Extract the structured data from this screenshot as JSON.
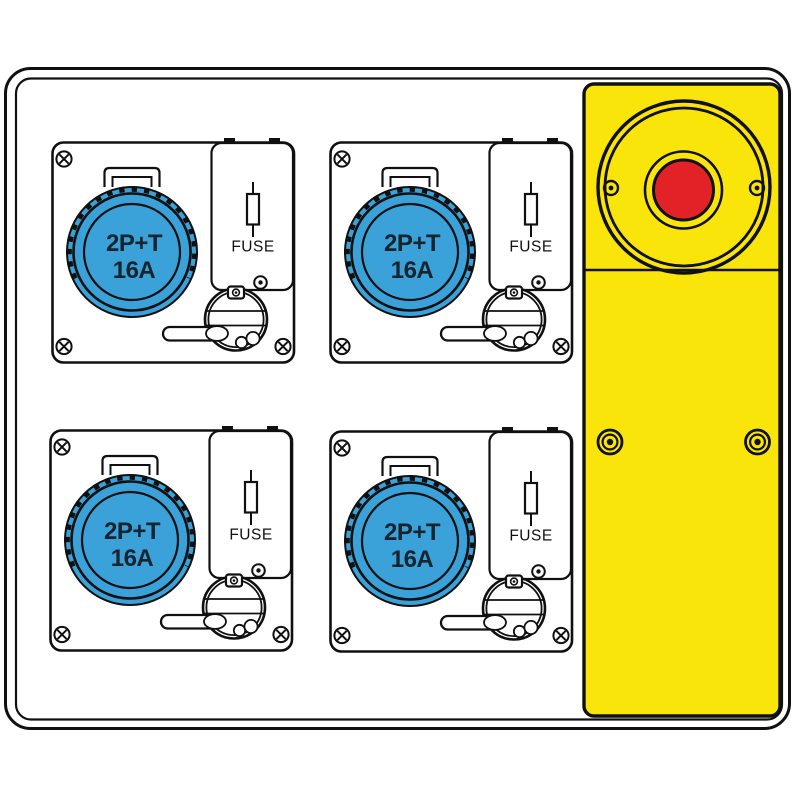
{
  "modules": [
    {
      "socket_line1": "2P+T",
      "socket_line2": "16A",
      "fuse_label": "FUSE"
    },
    {
      "socket_line1": "2P+T",
      "socket_line2": "16A",
      "fuse_label": "FUSE"
    },
    {
      "socket_line1": "2P+T",
      "socket_line2": "16A",
      "fuse_label": "FUSE"
    },
    {
      "socket_line1": "2P+T",
      "socket_line2": "16A",
      "fuse_label": "FUSE"
    }
  ],
  "colors": {
    "socket_blue": "#3BA1D9",
    "label_dark": "#16242E",
    "panel_yellow": "#FAE50A",
    "button_red": "#E32227",
    "line": "#101010"
  }
}
